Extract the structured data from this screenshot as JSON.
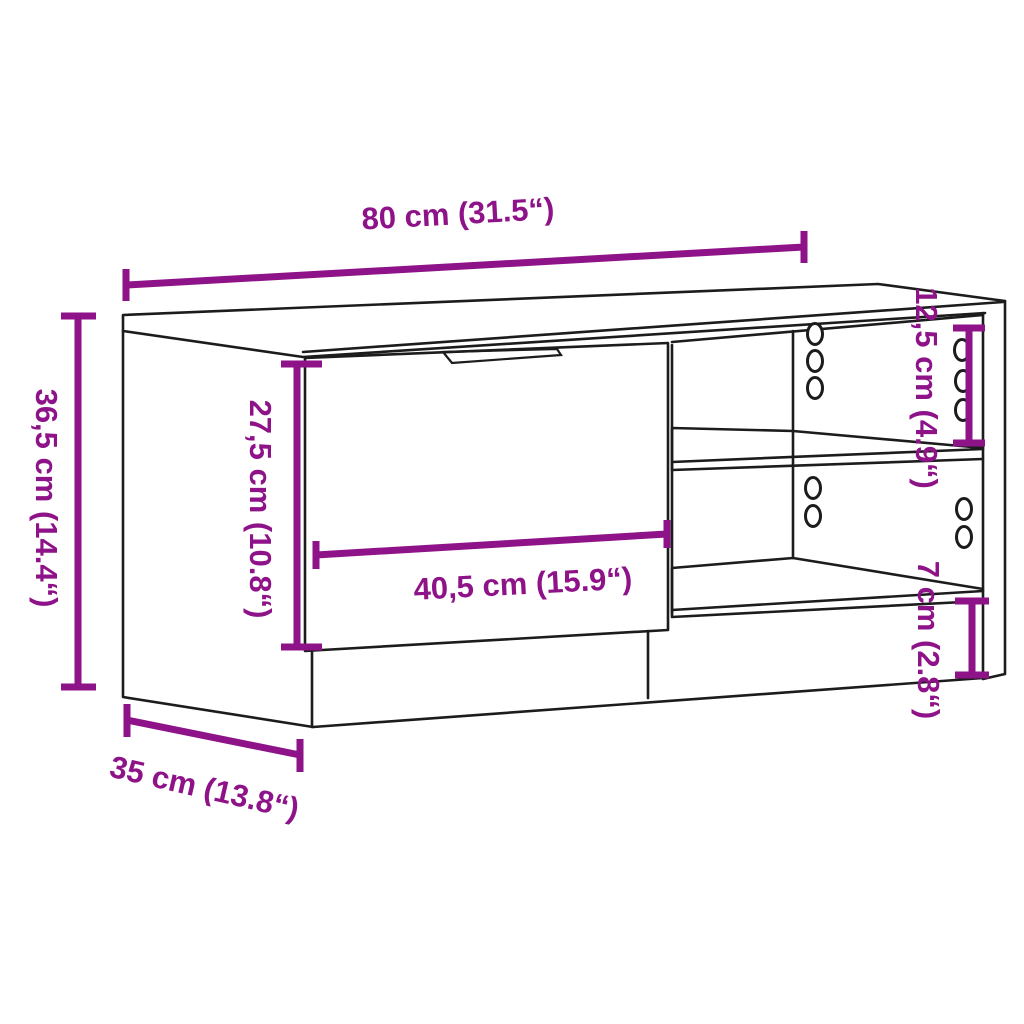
{
  "diagram": {
    "type": "furniture-dimension-diagram",
    "product": "TV cabinet with door and open shelves",
    "colors": {
      "dimension": "#8E1288",
      "line": "#1c1c1c",
      "background": "#ffffff"
    },
    "dimensions": {
      "overall_width": {
        "label": "80 cm (31.5“)",
        "cm": "80",
        "inches": "31.5"
      },
      "overall_height": {
        "label": "36,5 cm (14.4“)",
        "cm": "36,5",
        "inches": "14.4"
      },
      "door_height": {
        "label": "27,5 cm (10.8“)",
        "cm": "27,5",
        "inches": "10.8"
      },
      "door_width": {
        "label": "40,5 cm (15.9“)",
        "cm": "40,5",
        "inches": "15.9"
      },
      "shelf_opening_height": {
        "label": "12,5 cm (4.9“)",
        "cm": "12,5",
        "inches": "4.9"
      },
      "base_height": {
        "label": "7 cm (2.8“)",
        "cm": "7",
        "inches": "2.8"
      },
      "overall_depth": {
        "label": "35 cm (13.8“)",
        "cm": "35",
        "inches": "13.8"
      }
    }
  }
}
